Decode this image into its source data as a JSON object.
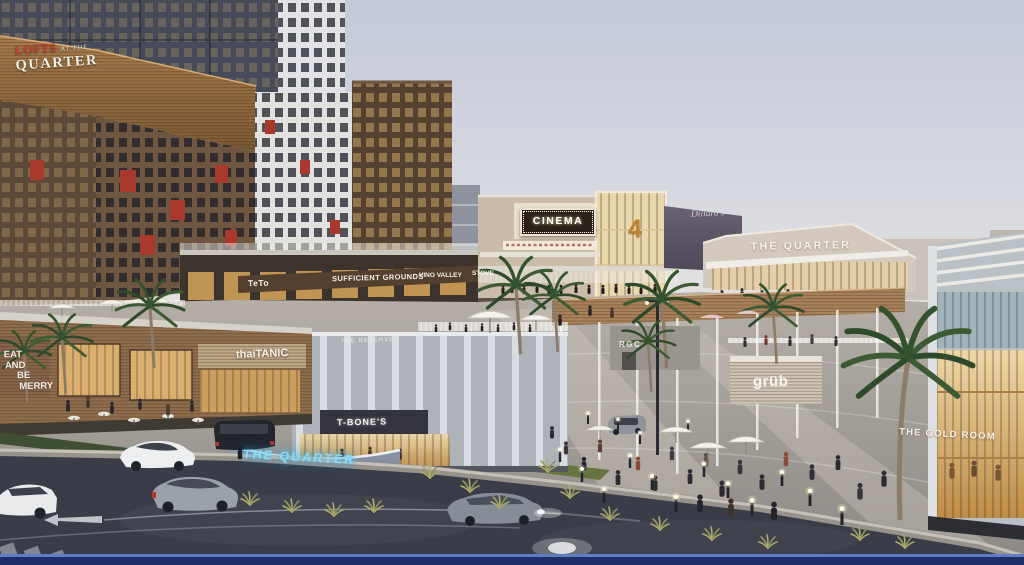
{
  "scene": {
    "signs": {
      "lofts": {
        "word_red": "LOFTS",
        "word_small": "AT THE",
        "word_main": "QUARTER"
      },
      "cinema": {
        "label": "CINEMA",
        "auditorium_number": "4"
      },
      "quarter_building": {
        "label": "THE QUARTER"
      },
      "department_store_script": {
        "label": "Dillard's"
      },
      "teto": {
        "label": "TeTo"
      },
      "sufficient_grounds": {
        "label": "SUFFICIENT GROUNDS"
      },
      "vino_valley": {
        "label": "VINO VALLEY"
      },
      "stove": {
        "label": "STOVE"
      },
      "thaitanic": {
        "label": "thaiTANIC"
      },
      "the_reserve": {
        "label": "THE RESERVE"
      },
      "mural": {
        "lines": [
          "EAT",
          "AND",
          "BE",
          "MERRY"
        ]
      },
      "tbones": {
        "label": "T-BONE'S"
      },
      "quarter_neon_wall": {
        "label": "THE QUARTER"
      },
      "grub": {
        "label": "grüb"
      },
      "rgc": {
        "label": "RGC"
      },
      "gold_room": {
        "label": "THE GOLD ROOM"
      }
    },
    "palette": {
      "sky_top": "#c3c9d8",
      "sky_horizon": "#f8eed6",
      "wood_facade": "#8a6a4a",
      "accent_red": "#a8392c",
      "warm_glass": "#e5b771",
      "asphalt": "#3a3d47",
      "neon_blue": "#8bdcf8",
      "bottom_border": "#1e2e66"
    }
  }
}
